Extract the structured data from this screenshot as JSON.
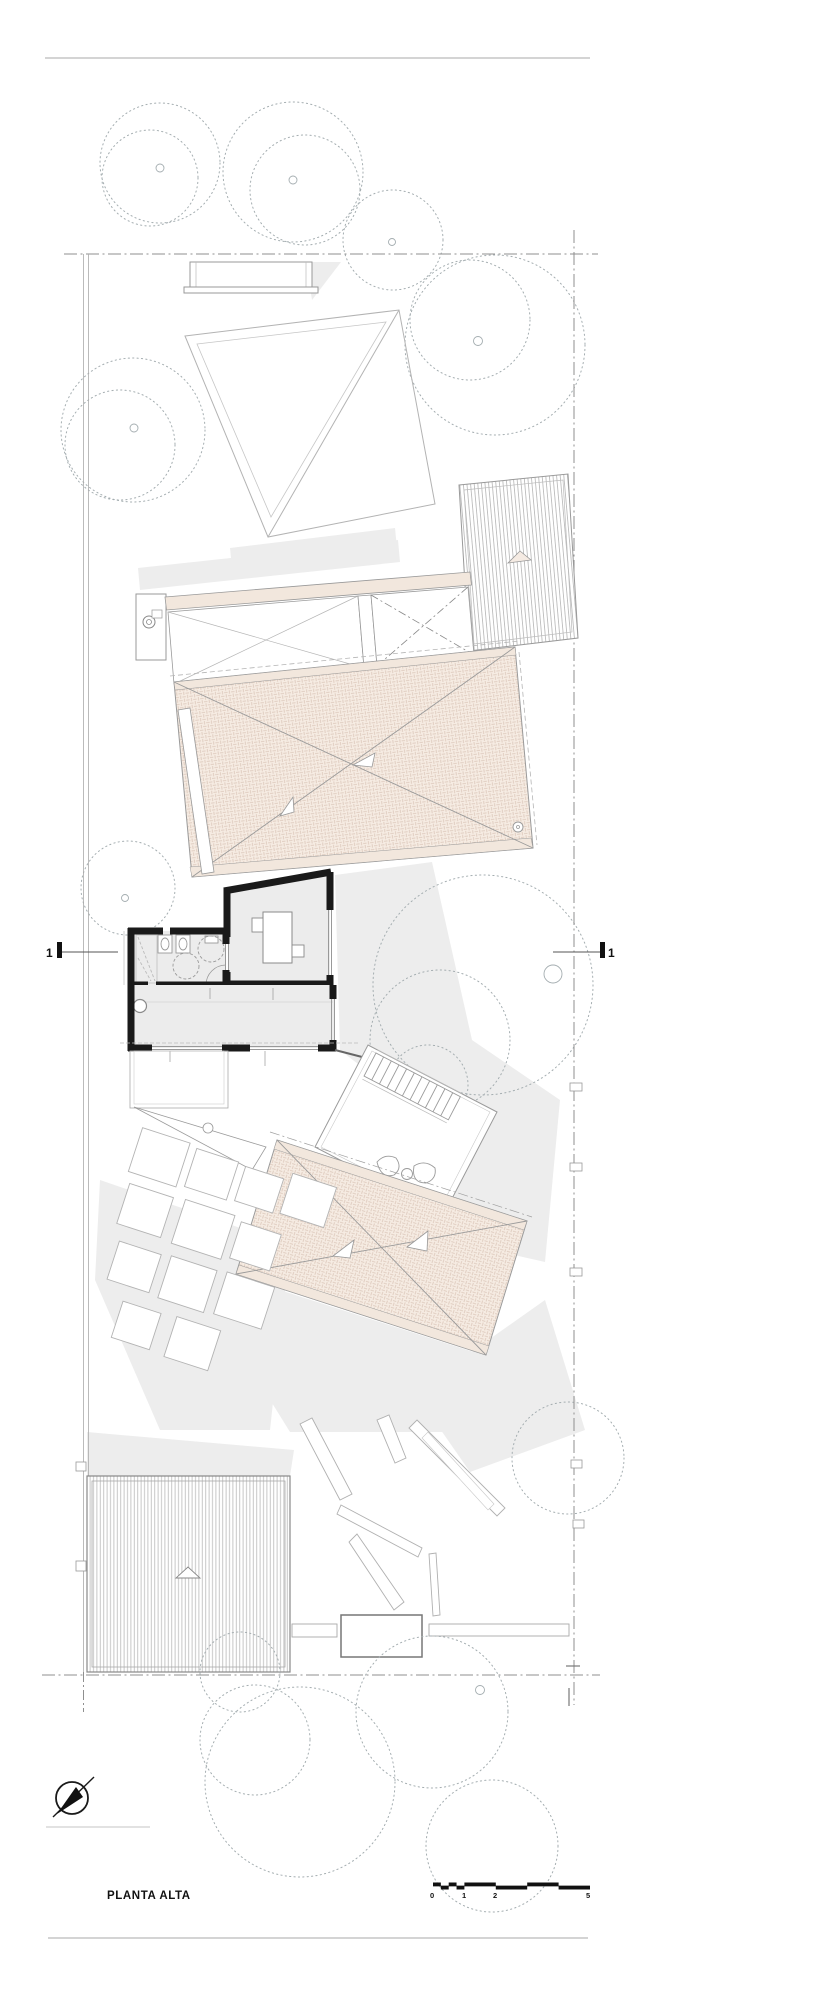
{
  "title": {
    "text": "PLANTA ALTA"
  },
  "section_marker": {
    "left_label": "1",
    "right_label": "1"
  },
  "scale_bar": {
    "labels": [
      "0",
      "1",
      "2",
      "5"
    ]
  },
  "icons": {
    "north_arrow": "north-arrow-icon"
  },
  "colors": {
    "wall_black": "#1a1a1a",
    "line_gray": "#9a9a9a",
    "tree_dot": "#a4adb0",
    "tile_fill": "#f6ece3",
    "tile_line": "#ddc9bc",
    "beam_beige": "#f2e7dd",
    "floor_gray": "#ececec",
    "shadow_gray": "#ededed",
    "boundary_gray": "#8f8f8f",
    "text_dark": "#111111"
  }
}
